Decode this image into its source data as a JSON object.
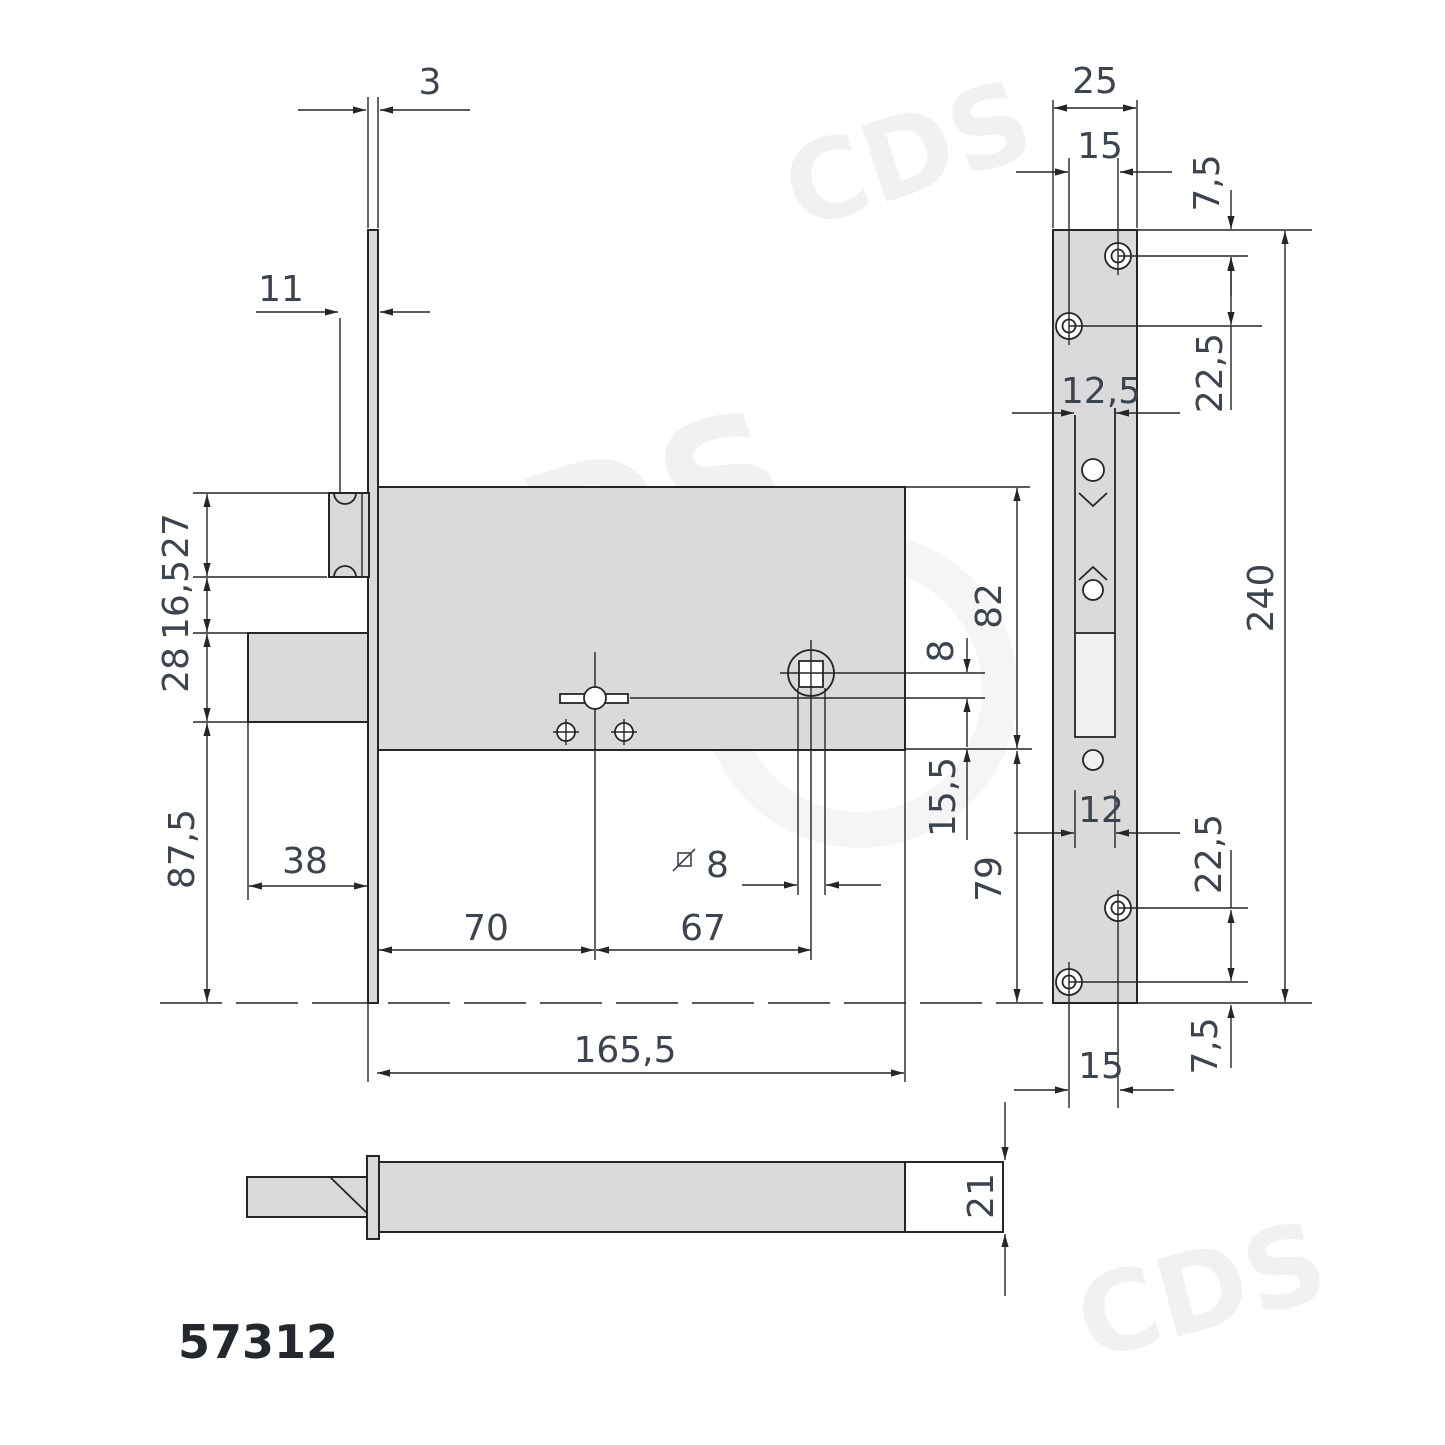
{
  "part_number": "57312",
  "watermark": "CDS",
  "side_view": {
    "faceplate_thickness": "3",
    "latch_offset": "11",
    "latch_height": "27",
    "latch_bolt_gap": "16,5",
    "bolt_height": "28",
    "bolt_to_plate_end": "87,5",
    "bolt_throw": "38",
    "key_backset": "70",
    "key_to_spindle": "67",
    "spindle_square": "8",
    "body_length": "165,5",
    "body_height": "82",
    "spindle_key_gap": "8",
    "key_to_body_edge": "15,5",
    "body_to_plate_end": "79"
  },
  "front_view": {
    "plate_width": "25",
    "screw_spacing_top": "15",
    "screw_edge_offset_top": "7,5",
    "screw_gap_top": "22,5",
    "keyway_width": "12,5",
    "plate_height": "240",
    "bolt_slot_width": "12",
    "screw_gap_bottom": "22,5",
    "screw_spacing_bottom": "15",
    "screw_edge_offset_bottom": "7,5"
  },
  "bottom_view": {
    "body_thickness": "21"
  }
}
